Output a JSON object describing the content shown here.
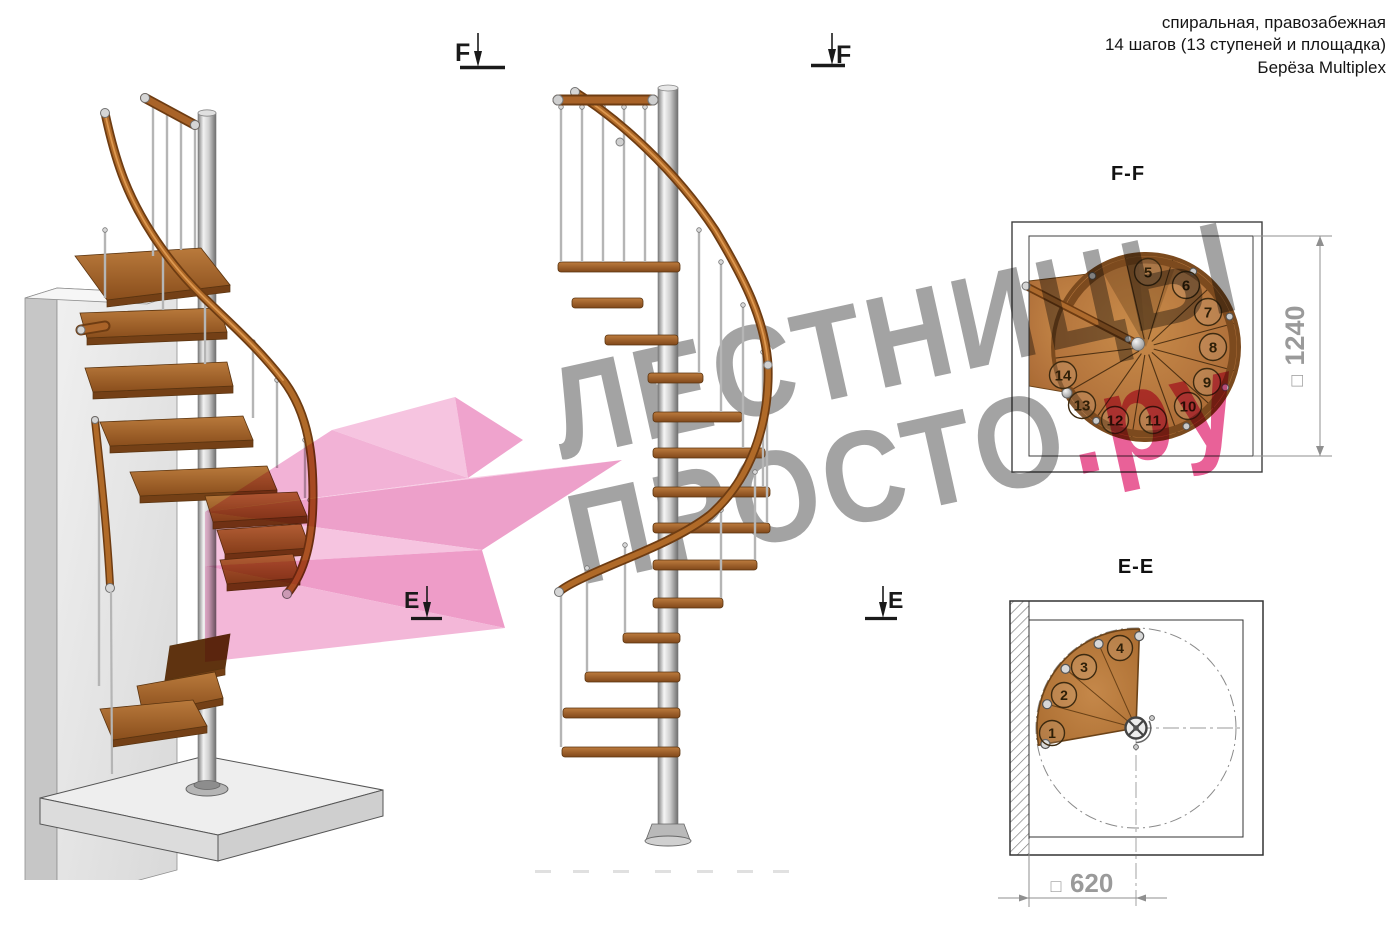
{
  "header": {
    "lines": [
      "спиральная, правозабежная",
      "14 шагов (13 ступеней и площадка)",
      "Берёза Multiplex"
    ]
  },
  "watermark": {
    "line1": "ЛЕСТНИЦЫ",
    "line2_gray": "ПРОСТО",
    "line2_pink": ".ру",
    "gray_color": "#9b9b9b",
    "pink_color": "#e7538f"
  },
  "sections": {
    "ff": {
      "label": "F-F",
      "dim_symbol": "□",
      "dimension": "1240",
      "steps": [
        "5",
        "6",
        "7",
        "8",
        "9",
        "10",
        "11",
        "12",
        "13",
        "14"
      ]
    },
    "ee": {
      "label": "E-E",
      "dim_symbol": "□",
      "dimension": "620",
      "steps": [
        "1",
        "2",
        "3",
        "4"
      ]
    }
  },
  "markers": {
    "f_label": "F",
    "e_label": "E"
  },
  "colors": {
    "wood": "#b0703a",
    "wood_dark": "#6b4217",
    "metal": "#c9c9c9",
    "dim_gray": "#9a9a9a",
    "line_dark": "#3a3a3a"
  }
}
